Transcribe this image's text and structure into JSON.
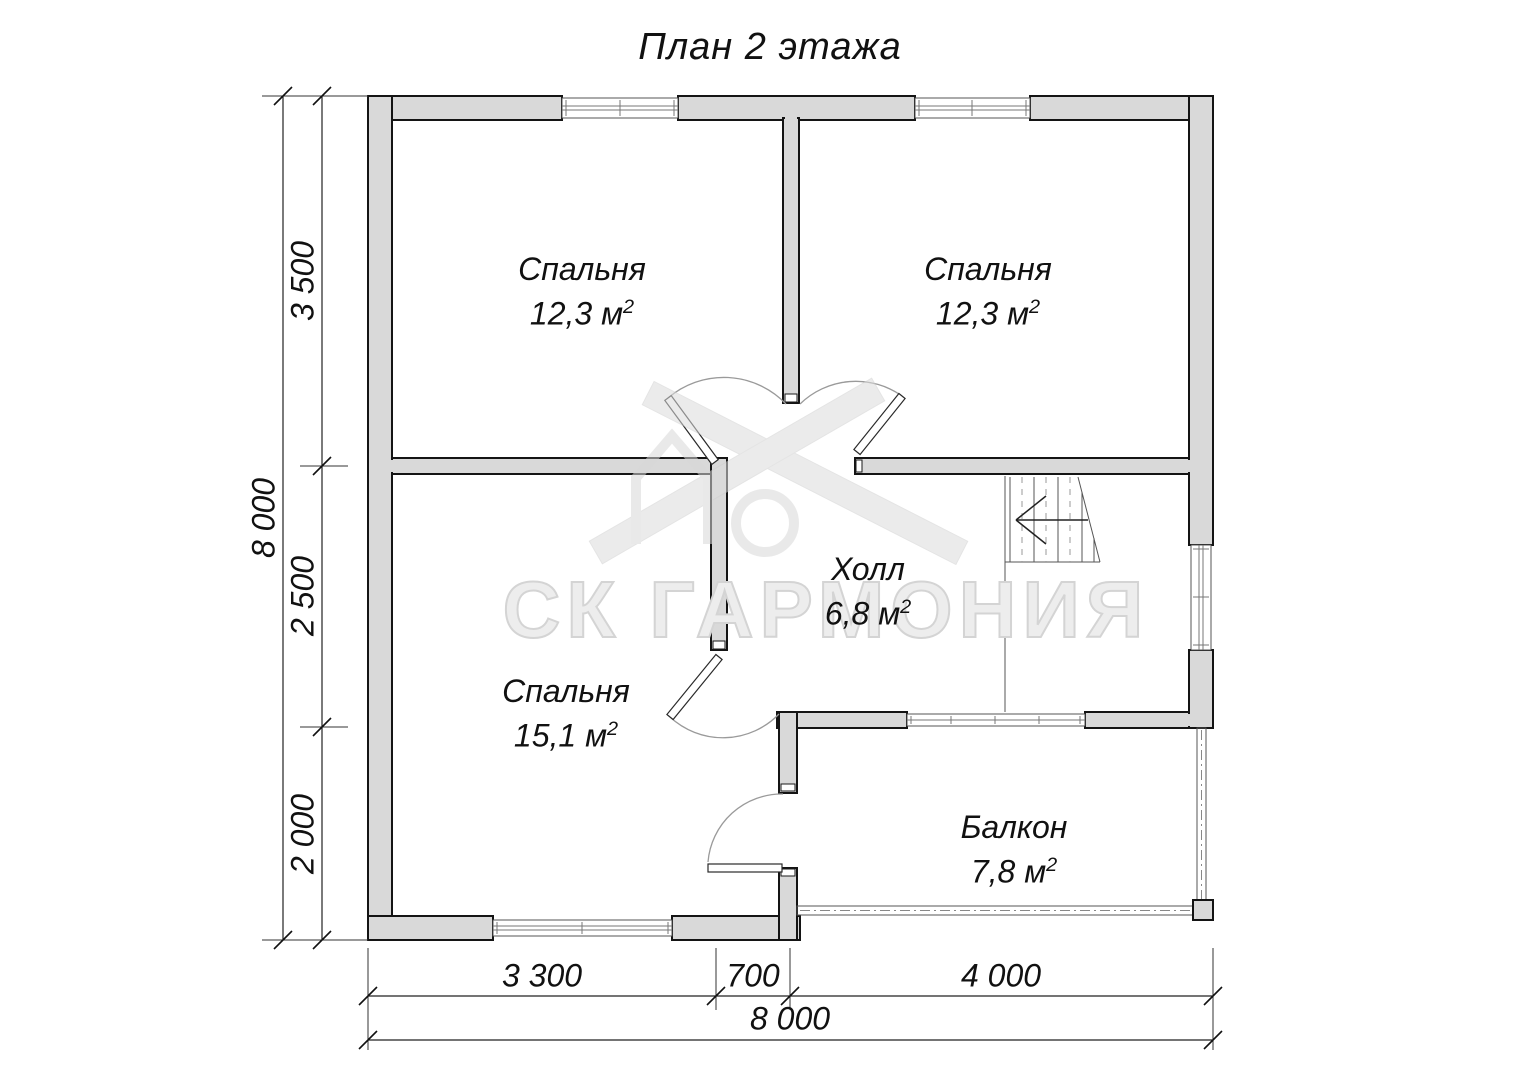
{
  "title": "План 2 этажа",
  "rooms": [
    {
      "name": "Спальня",
      "area": "12,3 м",
      "sup": "2"
    },
    {
      "name": "Спальня",
      "area": "12,3 м",
      "sup": "2"
    },
    {
      "name": "Спальня",
      "area": "15,1 м",
      "sup": "2"
    },
    {
      "name": "Холл",
      "area": "6,8 м",
      "sup": "2"
    },
    {
      "name": "Балкон",
      "area": "7,8 м",
      "sup": "2"
    }
  ],
  "dimensions": {
    "vertical_total": "8 000",
    "vertical_segments": [
      "3 500",
      "2 500",
      "2 000"
    ],
    "horizontal_segments": [
      "3 300",
      "700",
      "4 000"
    ],
    "horizontal_total": "8 000"
  },
  "watermark": {
    "brand": "СК ГАРМОНИЯ"
  },
  "colors": {
    "wall_fill": "#d9d9d9",
    "wall_line": "#141414",
    "thin_line": "#555555",
    "arc_line": "#9a9a9a",
    "dim_line": "#222222",
    "text_color": "#111111",
    "watermark_fill": "#ededed",
    "watermark_stroke": "#d4d4d4"
  }
}
